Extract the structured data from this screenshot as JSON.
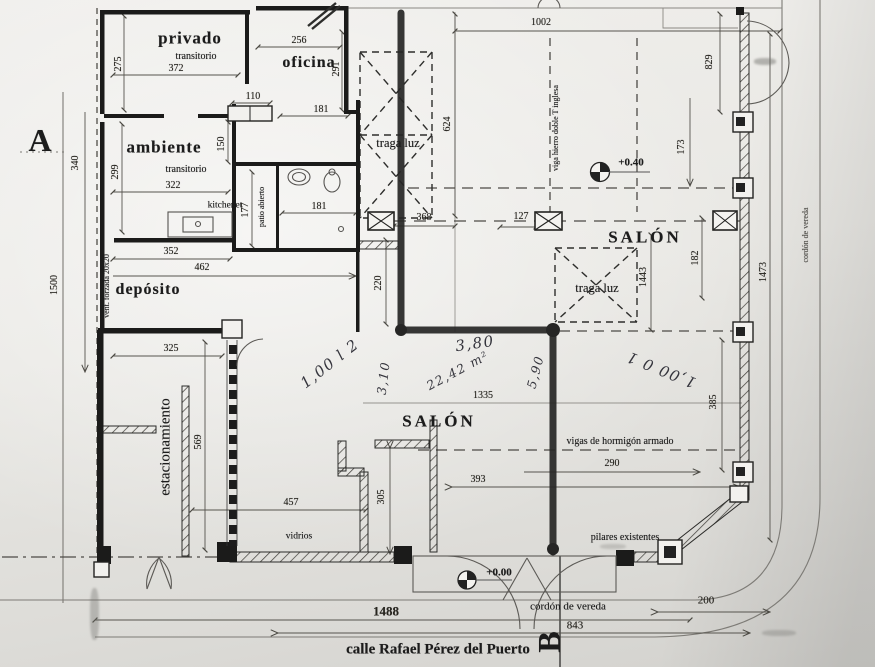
{
  "section_marks": {
    "a": "A",
    "b": "B"
  },
  "street": {
    "name": "calle Rafael Pérez del Puerto"
  },
  "rooms": {
    "privado": "privado",
    "privado_sub": "transitorio",
    "oficina": "oficina",
    "ambiente": "ambiente",
    "ambiente_sub": "transitorio",
    "kitchenet": "kitchenet",
    "patio_abierto": "patio abierto",
    "deposito": "depósito",
    "estacionamiento": "estacionamiento",
    "salon_centro": "SALÓN",
    "salon_derecha": "SALÓN",
    "tragaluz_izq": "traga luz",
    "tragaluz_der": "traga luz"
  },
  "annotations": {
    "vidrios": "vidrios",
    "vigas_hormigon": "vigas de hormigón armado",
    "pilares_existentes": "pilares existentes",
    "vent_forzada": "vent. forzada 20x20",
    "viga_hierro": "viga hierro doble T inglesa",
    "cordon_vereda_derecha": "cordón de vereda",
    "cordon_vereda_abajo": "cordón de vereda",
    "nivel_salon": "+0.40",
    "nivel_entrada": "+0.00"
  },
  "dimensions": {
    "d275": "275",
    "d372": "372",
    "d256": "256",
    "d291": "291",
    "d110": "110",
    "d181_top": "181",
    "d150": "150",
    "d299": "299",
    "d322": "322",
    "d177": "177",
    "d181_bano": "181",
    "d352": "352",
    "d462": "462",
    "d325": "325",
    "d340": "340",
    "d1500": "1500",
    "d569": "569",
    "d1002": "1002",
    "d829": "829",
    "d624": "624",
    "d173": "173",
    "d127": "127",
    "d368": "368",
    "d220": "220",
    "d1443": "1443",
    "d182": "182",
    "d1473": "1473",
    "d1335": "1335",
    "d385": "385",
    "d290": "290",
    "d393": "393",
    "d457": "457",
    "d305": "305",
    "d1488": "1488",
    "d843": "843",
    "d200": "200"
  },
  "handwritten": {
    "hw_380": "3,80",
    "hw_2242": "22,42 m²",
    "hw_590": "5,90",
    "hw_310": "3,10",
    "hw_nota_izq": "1,00 l 2",
    "hw_nota_der": "1,00 0 1"
  }
}
